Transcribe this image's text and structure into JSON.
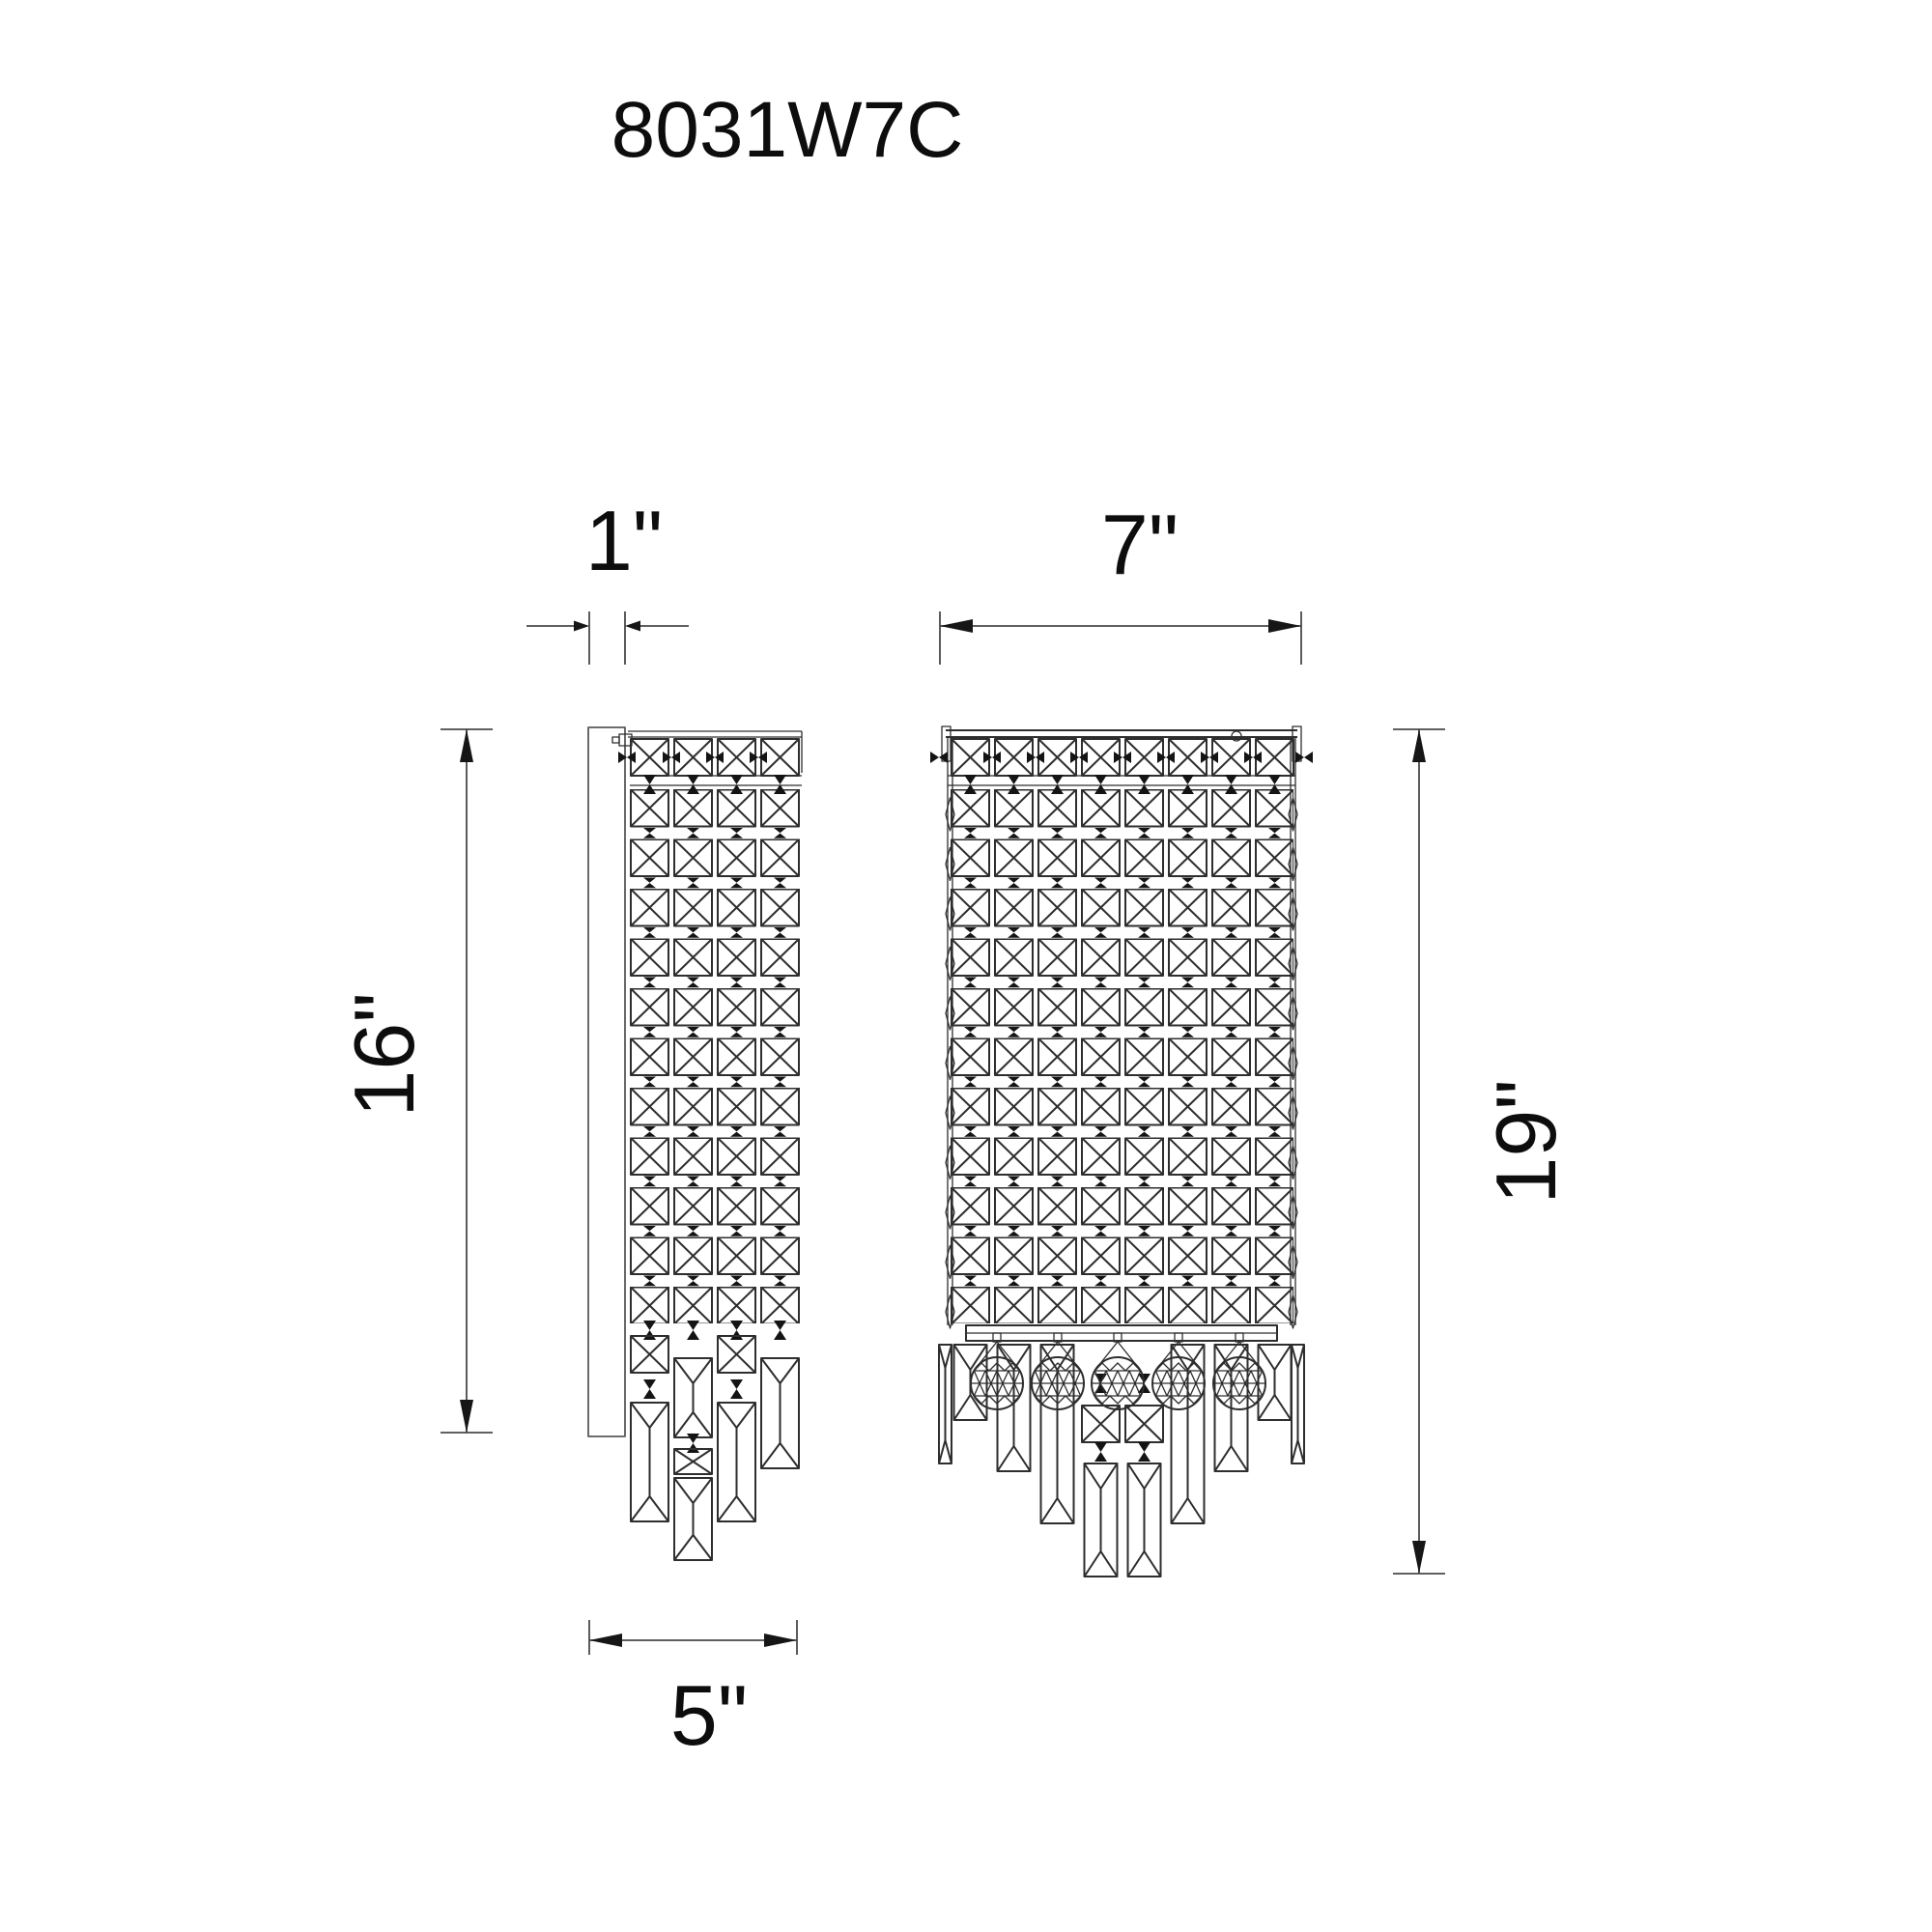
{
  "title": "8031W7C",
  "dimension_labels": {
    "backplate_depth": "1\"",
    "frame_width": "7\"",
    "backplate_height": "16\"",
    "overall_height": "19\"",
    "bottom_width": "5\""
  },
  "views": {
    "side_view": "side profile of sconce",
    "front_view": "front elevation of sconce"
  },
  "colors": {
    "line": "#2e2e2e",
    "dimension_line": "#4a4a4a",
    "text": "#0d0d0d",
    "background": "#ffffff"
  }
}
